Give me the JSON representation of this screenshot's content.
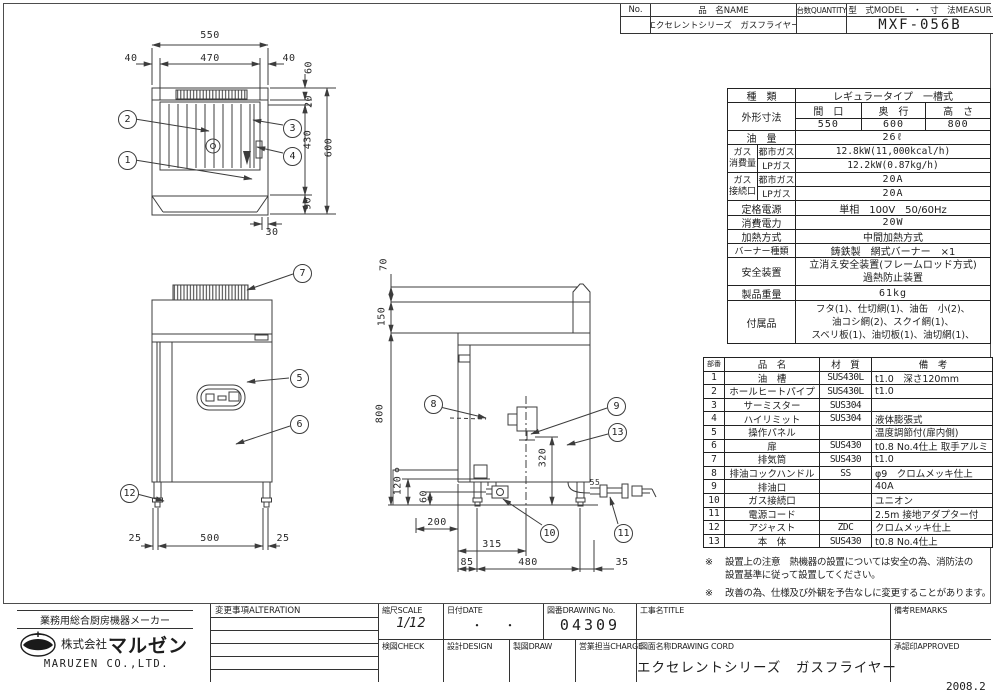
{
  "page": {
    "date_code": "2008.2"
  },
  "header": {
    "no_label": "No.",
    "name_label": "品　名NAME",
    "qty_label": "台数QUANTITY",
    "model_label": "型　式MODEL　・　寸　法MEASUR",
    "name_value": "エクセレントシリーズ　ガスフライヤー",
    "model_value": "MXF-056B"
  },
  "spec": {
    "kind_label": "種　類",
    "kind_value": "レギュラータイプ　一槽式",
    "outer_dim_label": "外形寸法",
    "width_label": "間　口",
    "depth_label": "奥　行",
    "height_label": "高　さ",
    "width_value": "550",
    "depth_value": "600",
    "height_value": "800",
    "oil_label": "油　量",
    "oil_value": "26ℓ",
    "gas_consumption_label": "ガス\n消費量",
    "city_gas_label": "都市ガス",
    "lp_gas_label": "LPガス",
    "city_gas_value": "12.8kW(11,000kcal/h)",
    "lp_gas_value": "12.2kW(0.87kg/h)",
    "gas_connection_label": "ガス\n接続口",
    "conn_city_label": "都市ガス",
    "conn_lp_label": "LPガス",
    "conn_city_value": "20A",
    "conn_lp_value": "20A",
    "power_label": "定格電源",
    "power_value": "単相　100V　50/60Hz",
    "wattage_label": "消費電力",
    "wattage_value": "20W",
    "heating_label": "加熱方式",
    "heating_value": "中間加熱方式",
    "burner_label": "バーナー種類",
    "burner_value": "鋳鉄製　網式バーナー　×1",
    "safety_label": "安全装置",
    "safety_line1": "立消え安全装置(フレームロッド方式)",
    "safety_line2": "過熱防止装置",
    "weight_label": "製品重量",
    "weight_value": "61kg",
    "accessories_label": "付属品",
    "accessories_line1": "フタ(1)、仕切網(1)、油缶　小(2)、",
    "accessories_line2": "油コシ網(2)、スクイ網(1)、",
    "accessories_line3": "スベリ板(1)、油切板(1)、油切網(1)、"
  },
  "parts": {
    "headers": [
      "部番",
      "品　名",
      "材　質",
      "備　考"
    ],
    "rows": [
      [
        "1",
        "油　槽",
        "SUS430L",
        "t1.0　深さ120mm"
      ],
      [
        "2",
        "ホールヒートパイプ",
        "SUS430L",
        "t1.0"
      ],
      [
        "3",
        "サーミスター",
        "SUS304",
        ""
      ],
      [
        "4",
        "ハイリミット",
        "SUS304",
        "液体膨張式"
      ],
      [
        "5",
        "操作パネル",
        "",
        "温度調節付(扉内側)"
      ],
      [
        "6",
        "扉",
        "SUS430",
        "t0.8 No.4仕上 取手アルミ"
      ],
      [
        "7",
        "排気筒",
        "SUS430",
        "t1.0"
      ],
      [
        "8",
        "排油コックハンドル",
        "SS",
        "φ9　クロムメッキ仕上"
      ],
      [
        "9",
        "排油口",
        "",
        "40A"
      ],
      [
        "10",
        "ガス接続口",
        "",
        "ユニオン"
      ],
      [
        "11",
        "電源コード",
        "",
        "2.5m 接地アダプター付"
      ],
      [
        "12",
        "アジャスト",
        "ZDC",
        "クロムメッキ仕上"
      ],
      [
        "13",
        "本　体",
        "SUS430",
        "t0.8 No.4仕上"
      ]
    ]
  },
  "notes": {
    "mark": "※",
    "note1_line1": "設置上の注意　熱機器の設置については安全の為、消防法の",
    "note1_line2": "設置基準に従って設置してください。",
    "note2": "改善の為、仕様及び外観を予告なしに変更することがあります。"
  },
  "title_block": {
    "company_slogan": "業務用総合厨房機器メーカー",
    "company_prefix": "株式会社",
    "company_logo_text": "マルゼン",
    "company_en": "MARUZEN CO.,LTD.",
    "alteration_label": "変更事項ALTERATION",
    "scale_label": "縮尺SCALE",
    "scale_value": "1/12",
    "date_label": "日付DATE",
    "date_value": "・　　・",
    "drawing_no_label": "図番DRAWING No.",
    "drawing_no_value": "04309",
    "title_label": "工事名TITLE",
    "remarks_label": "備考REMARKS",
    "check_label": "検図CHECK",
    "design_label": "設計DESIGN",
    "draw_label": "製図DRAW",
    "charge_label": "営業担当CHARGE",
    "drawing_name_label": "図面名称DRAWING CORD",
    "drawing_name_value": "エクセレントシリーズ　ガスフライヤー",
    "approved_label": "承認印APPROVED"
  },
  "plan_view": {
    "balloons": [
      "1",
      "2",
      "3",
      "4"
    ],
    "dims": {
      "total_w": "550",
      "margin_l": "40",
      "inner_w": "470",
      "margin_r": "40",
      "d60": "60",
      "d20": "20",
      "d430": "430",
      "total_d": "600",
      "d90": "90",
      "d30": "30"
    }
  },
  "front_view": {
    "balloons": [
      "7",
      "5",
      "6",
      "12"
    ],
    "dims": {
      "leg_l": "25",
      "leg_span": "500",
      "leg_r": "25"
    }
  },
  "side_view": {
    "balloons": [
      "8",
      "9",
      "13",
      "10",
      "11"
    ],
    "dims": {
      "d70": "70",
      "d150": "150",
      "d800": "800",
      "d120": "120",
      "d60": "60",
      "d200": "200",
      "d315": "315",
      "d85": "85",
      "d480": "480",
      "d35": "35",
      "d320": "320",
      "d55": "55"
    }
  }
}
